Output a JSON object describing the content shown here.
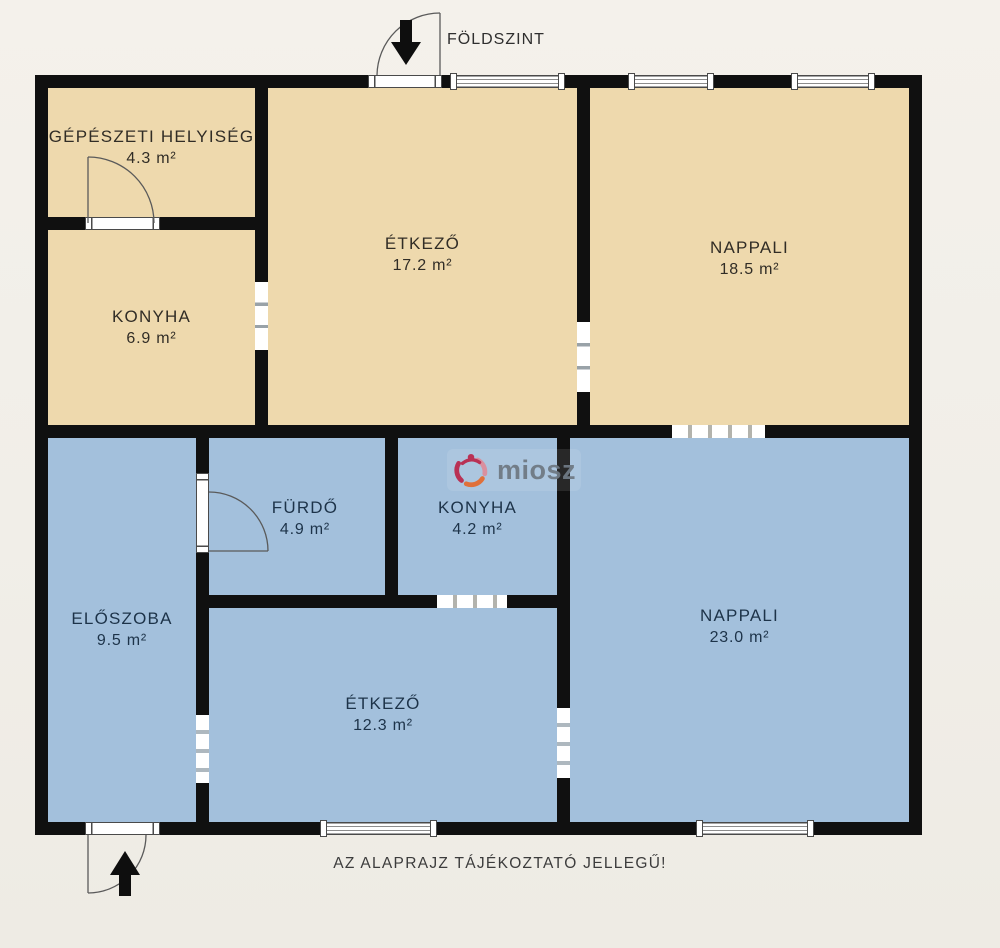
{
  "plan": {
    "floor_label": "FÖLDSZINT",
    "disclaimer": "AZ ALAPRAJZ TÁJÉKOZTATÓ JELLEGŰ!",
    "watermark_brand": "miosz",
    "colors": {
      "background": "#f1eee8",
      "wall": "#101010",
      "upper_floor_fill": "#eed9ad",
      "lower_floor_fill": "#a3c0dc",
      "upper_text": "#312d26",
      "lower_text": "#1d3349",
      "watermark_text": "#6f7a84",
      "logo_crimson": "#b93154",
      "logo_orange": "#e0703a",
      "logo_pink": "#d9909f"
    },
    "rooms": [
      {
        "name": "GÉPÉSZETI HELYISÉG",
        "area": "4.3 m²",
        "floor": "upper"
      },
      {
        "name": "ÉTKEZŐ",
        "area": "17.2 m²",
        "floor": "upper"
      },
      {
        "name": "NAPPALI",
        "area": "18.5 m²",
        "floor": "upper"
      },
      {
        "name": "KONYHA",
        "area": "6.9 m²",
        "floor": "upper"
      },
      {
        "name": "FÜRDŐ",
        "area": "4.9 m²",
        "floor": "lower"
      },
      {
        "name": "KONYHA",
        "area": "4.2 m²",
        "floor": "lower"
      },
      {
        "name": "ELŐSZOBA",
        "area": "9.5 m²",
        "floor": "lower"
      },
      {
        "name": "ÉTKEZŐ",
        "area": "12.3 m²",
        "floor": "lower"
      },
      {
        "name": "NAPPALI",
        "area": "23.0 m²",
        "floor": "lower"
      }
    ]
  }
}
